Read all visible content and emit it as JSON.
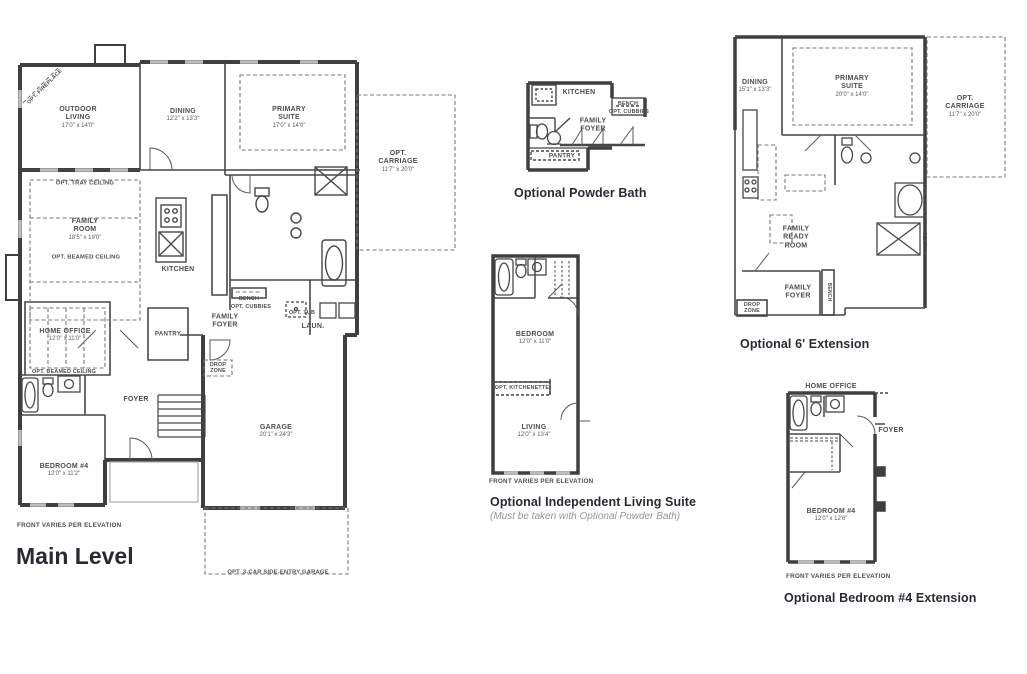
{
  "meta": {
    "drawing_type": "residential floor plan sheet",
    "colors": {
      "background": "#ffffff",
      "walls": "#3f3f3f",
      "text": "#4d4d4d",
      "titles": "#2b2a33",
      "muted": "#949494"
    }
  },
  "main_level": {
    "title": "Main Level",
    "footnote": "FRONT VARIES PER ELEVATION",
    "rooms": {
      "outdoor_living": {
        "name": "OUTDOOR LIVING",
        "dims": "17'0\" x 14'0\""
      },
      "dining": {
        "name": "DINING",
        "dims": "12'2\" x 13'3\""
      },
      "primary_suite": {
        "name": "PRIMARY SUITE",
        "dims": "17'0\" x 14'0\""
      },
      "opt_carriage": {
        "name": "OPT. CARRIAGE",
        "dims": "11'7\" x 20'0\""
      },
      "family_room": {
        "name": "FAMILY ROOM",
        "dims": "18'5\" x 19'0\""
      },
      "kitchen": {
        "name": "KITCHEN"
      },
      "home_office": {
        "name": "HOME OFFICE",
        "dims": "12'0\" x 11'0\""
      },
      "pantry": {
        "name": "PANTRY"
      },
      "family_foyer": {
        "name": "FAMILY FOYER"
      },
      "laundry": {
        "name": "LAUN."
      },
      "foyer": {
        "name": "FOYER"
      },
      "bedroom4": {
        "name": "BEDROOM #4",
        "dims": "12'0\" x 11'2\""
      },
      "garage": {
        "name": "GARAGE",
        "dims": "20'1\" x 24'3\""
      }
    },
    "annotations": {
      "opt_fireplace": "OPT. FIREPLACE",
      "opt_tray_ceiling": "OPT. TRAY CEILING",
      "opt_beamed_ceiling_family": "OPT. BEAMED CEILING",
      "opt_beamed_ceiling_office": "OPT. BEAMED CEILING",
      "bench": "BENCH",
      "opt_cubbies": "OPT. CUBBIES",
      "drop_zone": "DROP ZONE",
      "opt_tub": "OPT. TUB",
      "opt_3car_garage": "OPT. 3-CAR SIDE-ENTRY GARAGE"
    }
  },
  "powder_bath": {
    "title": "Optional Powder Bath",
    "labels": {
      "kitchen": "KITCHEN",
      "bench": "BENCH",
      "opt_cubbies": "OPT. CUBBIES",
      "family_foyer": "FAMILY FOYER",
      "pantry": "PANTRY"
    }
  },
  "independent_suite": {
    "title": "Optional Independent Living Suite",
    "subtitle": "(Must be taken with Optional Powder Bath)",
    "footnote": "FRONT VARIES PER ELEVATION",
    "rooms": {
      "bedroom": {
        "name": "BEDROOM",
        "dims": "12'0\" x 11'0\""
      },
      "living": {
        "name": "LIVING",
        "dims": "12'0\" x 13'4\""
      }
    },
    "annotations": {
      "opt_kitchenette": "OPT. KITCHENETTE"
    }
  },
  "extension6": {
    "title": "Optional 6' Extension",
    "rooms": {
      "dining": {
        "name": "DINING",
        "dims": "15'1\" x 13'3\""
      },
      "primary_suite": {
        "name": "PRIMARY SUITE",
        "dims": "20'0\" x 14'0\""
      },
      "opt_carriage": {
        "name": "OPT. CARRIAGE",
        "dims": "11'7\" x 20'0\""
      },
      "family_ready_room": {
        "name": "FAMILY READY ROOM"
      },
      "family_foyer": {
        "name": "FAMILY FOYER"
      }
    },
    "annotations": {
      "bench": "BENCH",
      "seat": "SEAT",
      "drop_zone": "DROP ZONE"
    }
  },
  "bedroom4_extension": {
    "title": "Optional Bedroom #4 Extension",
    "footnote": "FRONT VARIES PER ELEVATION",
    "rooms": {
      "home_office": {
        "name": "HOME OFFICE"
      },
      "foyer": {
        "name": "FOYER"
      },
      "bedroom4": {
        "name": "BEDROOM #4",
        "dims": "12'0\" x 12'6\""
      }
    }
  }
}
